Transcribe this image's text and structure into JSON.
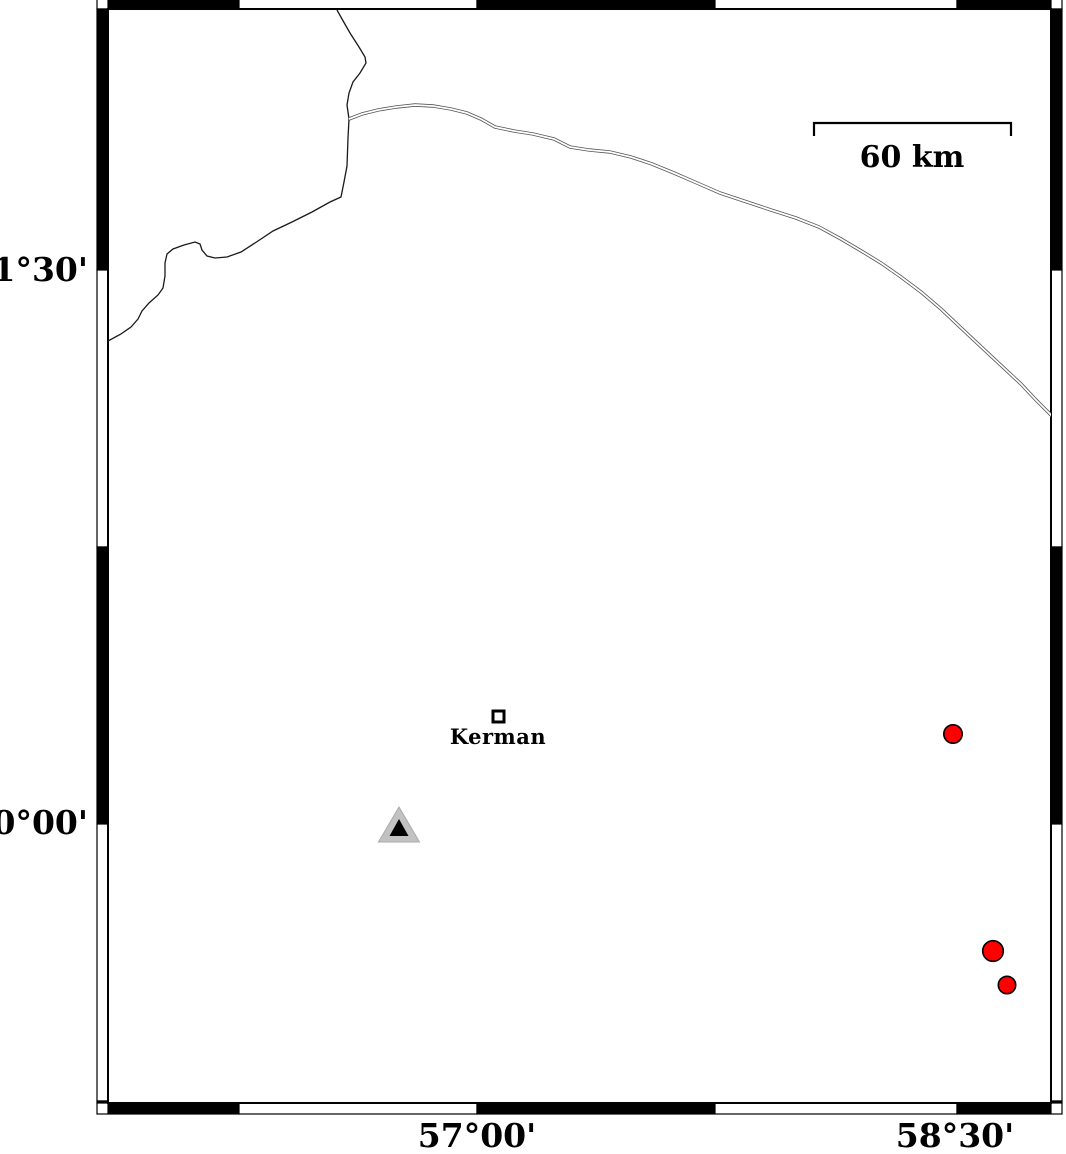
{
  "figure": {
    "type": "geographic-map",
    "projection_hint": "mercator",
    "region": "Kerman area, Iran"
  },
  "axis_labels": {
    "left": [
      {
        "text": "31°30'",
        "y": 270
      },
      {
        "text": "30°00'",
        "y": 823
      }
    ],
    "bottom": [
      {
        "text": "57°00'",
        "x": 477
      },
      {
        "text": "58°30'",
        "x": 955
      }
    ]
  },
  "scale_bar": {
    "label": "60 km",
    "x1": 814,
    "x2": 1011,
    "y": 123,
    "tick_len": 13,
    "label_x": 912,
    "label_y": 167
  },
  "city": {
    "name": "Kerman",
    "x": 498.5,
    "y": 716.5,
    "square_size": 11,
    "label_x": 498,
    "label_y": 744
  },
  "station": {
    "x": 399,
    "gray_triangle": {
      "apex_y": 807,
      "base_y": 842,
      "half_width": 20.5
    },
    "black_triangle": {
      "apex_y": 819,
      "base_y": 836,
      "half_width": 9.5
    }
  },
  "epicenters": [
    {
      "x": 953,
      "y": 734,
      "r": 9.2
    },
    {
      "x": 993,
      "y": 951,
      "r": 10.3
    },
    {
      "x": 1007,
      "y": 985,
      "r": 8.7
    }
  ],
  "features": {
    "boundary_line": [
      [
        337,
        10
      ],
      [
        342,
        19
      ],
      [
        350,
        33
      ],
      [
        359,
        47
      ],
      [
        365,
        57
      ],
      [
        366,
        63
      ],
      [
        360,
        73
      ],
      [
        353,
        82
      ],
      [
        349,
        93
      ],
      [
        347,
        105
      ],
      [
        349,
        119
      ],
      [
        348,
        138
      ],
      [
        347,
        166
      ],
      [
        344,
        182
      ],
      [
        341,
        197
      ],
      [
        330,
        202
      ],
      [
        312,
        212
      ],
      [
        292,
        222
      ],
      [
        273,
        231
      ],
      [
        258,
        241
      ],
      [
        241,
        252
      ],
      [
        227,
        257
      ],
      [
        215,
        258
      ],
      [
        207,
        256
      ],
      [
        202,
        250
      ],
      [
        200,
        244
      ],
      [
        195,
        242
      ],
      [
        184,
        245
      ],
      [
        173,
        249
      ],
      [
        167,
        254
      ],
      [
        165,
        263
      ],
      [
        165,
        276
      ],
      [
        163,
        288
      ],
      [
        158,
        295
      ],
      [
        149,
        303
      ],
      [
        142,
        311
      ],
      [
        138,
        319
      ],
      [
        131,
        327
      ],
      [
        121,
        334
      ],
      [
        108,
        341
      ]
    ],
    "road": [
      [
        349,
        119
      ],
      [
        362,
        114
      ],
      [
        378,
        110
      ],
      [
        396,
        107
      ],
      [
        415,
        105
      ],
      [
        433,
        106
      ],
      [
        451,
        109
      ],
      [
        467,
        113
      ],
      [
        481,
        119
      ],
      [
        495,
        127
      ],
      [
        514,
        131
      ],
      [
        533,
        134
      ],
      [
        554,
        139
      ],
      [
        570,
        147
      ],
      [
        589,
        150
      ],
      [
        610,
        152
      ],
      [
        631,
        157
      ],
      [
        652,
        164
      ],
      [
        674,
        173
      ],
      [
        697,
        183
      ],
      [
        720,
        193
      ],
      [
        744,
        201
      ],
      [
        771,
        210
      ],
      [
        796,
        218
      ],
      [
        819,
        227
      ],
      [
        841,
        239
      ],
      [
        863,
        252
      ],
      [
        881,
        263
      ],
      [
        901,
        277
      ],
      [
        921,
        292
      ],
      [
        941,
        309
      ],
      [
        959,
        326
      ],
      [
        976,
        342
      ],
      [
        991,
        356
      ],
      [
        1006,
        370
      ],
      [
        1021,
        384
      ],
      [
        1036,
        400
      ],
      [
        1052,
        416
      ]
    ]
  },
  "frame": {
    "map_rect": {
      "x": 108,
      "y": 9,
      "w": 943,
      "h": 1094
    },
    "band_thickness": 11,
    "x_bounds": [
      108,
      239,
      477,
      715,
      957,
      1051
    ],
    "y_bounds": [
      9,
      270,
      547,
      824,
      1101,
      1103
    ]
  },
  "colors": {
    "epicenter_fill": "#ff0000",
    "station_gray": "#c2c2c2",
    "station_black": "#000000",
    "road_casing": "#555555",
    "boundary_line": "#1a1a1a",
    "frame_black": "#000000",
    "frame_white": "#ffffff"
  }
}
